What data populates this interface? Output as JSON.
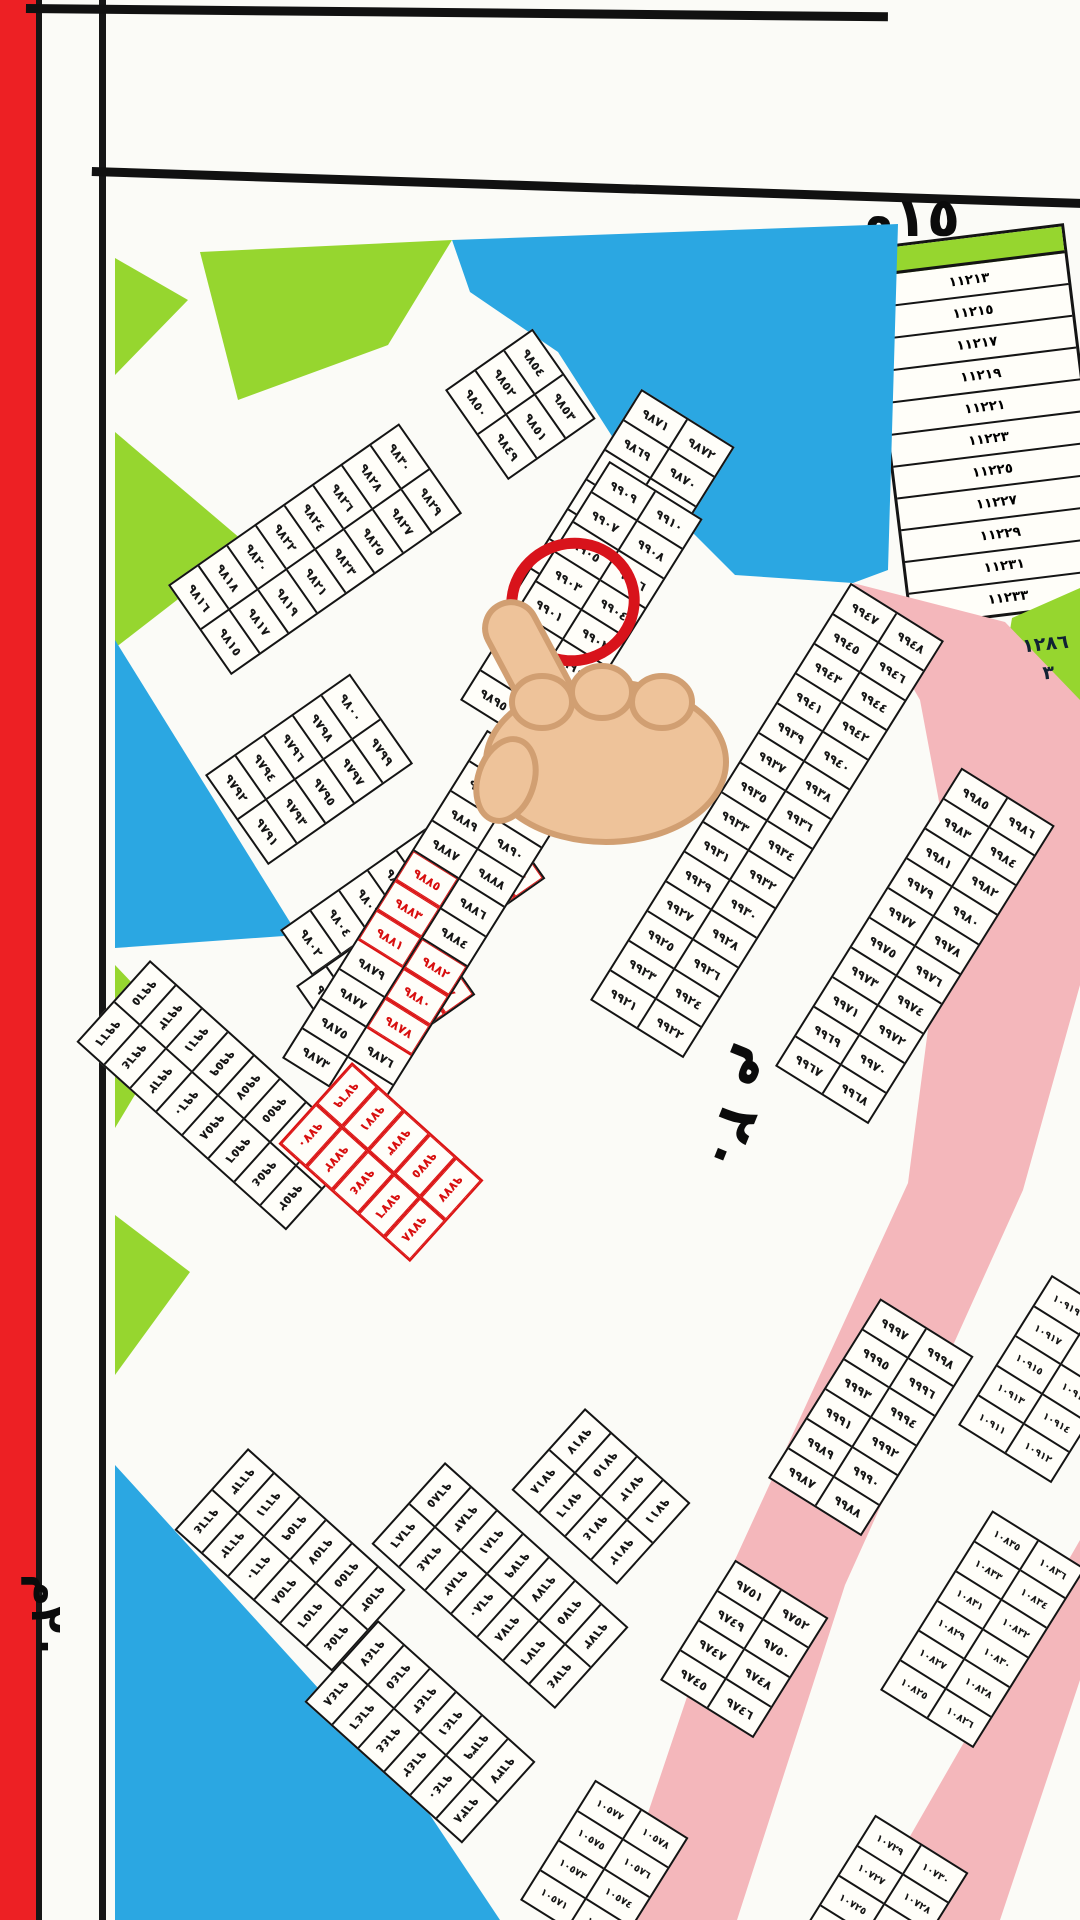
{
  "labels": {
    "street_top": "١٥م",
    "street_left": "٢٠م",
    "road_right": "٢٠ م",
    "green_block_line1": "١٢٨٦",
    "green_block_line2": "٣"
  },
  "highlight": {
    "circled_plot": "٩٩٠٣"
  },
  "colors": {
    "blue": "#2ba7e2",
    "green": "#96d62f",
    "pink": "#f4b7bb",
    "red_strip": "#ed2024",
    "circle_red": "#d8131b",
    "cell_red": "#db1212",
    "line_black": "#141414",
    "hand_skin": "#eec39a",
    "hand_outline": "#d19f72"
  },
  "right_column": {
    "cells": [
      "١١٢١٣",
      "١١٢١٥",
      "١١٢١٧",
      "١١٢١٩",
      "١١٢٢١",
      "١١٢٢٣",
      "١١٢٢٥",
      "١١٢٢٧",
      "١١٢٢٩",
      "١١٢٣١",
      "١١٢٣٣"
    ]
  },
  "zones": [
    {
      "name": "water-top",
      "color": "#2ba7e2",
      "points": "452px 240px, 898px 224px, 888px 570px, 853px 583px, 735px 575px, 640px 480px, 558px 352px, 470px 292px"
    },
    {
      "name": "green-top-trapezoid",
      "color": "#96d62f",
      "points": "200px 252px, 452px 240px, 388px 345px, 238px 400px"
    },
    {
      "name": "green-left-1",
      "color": "#96d62f",
      "points": "115px 258px, 188px 300px, 115px 375px"
    },
    {
      "name": "green-left-2",
      "color": "#96d62f",
      "points": "115px 432px, 248px 545px, 115px 648px"
    },
    {
      "name": "water-left",
      "color": "#2ba7e2",
      "points": "115px 640px, 298px 935px, 115px 948px"
    },
    {
      "name": "green-left-3",
      "color": "#96d62f",
      "points": "115px 965px, 175px 1028px, 115px 1128px"
    },
    {
      "name": "green-left-4",
      "color": "#96d62f",
      "points": "115px 1215px, 190px 1272px, 115px 1375px"
    },
    {
      "name": "water-bottom-left",
      "color": "#2ba7e2",
      "points": "115px 1465px, 420px 1800px, 500px 1920px, 115px 1920px"
    },
    {
      "name": "road-20m-main",
      "color": "#f4b7bb",
      "points": "853px 583px, 1005px 622px, 1080px 700px, 1080px 985px, 1023px 1190px, 845px 1585px, 737px 1920px, 612px 1920px, 728px 1575px, 908px 1183px, 950px 860px, 920px 700px"
    },
    {
      "name": "road-bottom-right",
      "color": "#f4b7bb",
      "points": "1080px 1540px, 1080px 1680px, 1000px 1920px, 862px 1920px"
    },
    {
      "name": "green-facility-block",
      "color": "#96d62f",
      "points": "1012px 618px, 1080px 588px, 1080px 758px, 1028px 748px, 1000px 690px"
    }
  ],
  "blocks": [
    {
      "name": "block-9815",
      "x": 168,
      "y": 585,
      "angle": -35,
      "top": [
        "٩٨١٦",
        "٩٨١٨",
        "٩٨٢٠",
        "٩٨٢٢",
        "٩٨٢٤",
        "٩٨٢٦",
        "٩٨٢٨",
        "٩٨٣٠"
      ],
      "bottom": [
        "٩٨١٥",
        "٩٨١٧",
        "٩٨١٩",
        "٩٨٢١",
        "٩٨٢٣",
        "٩٨٢٥",
        "٩٨٢٧",
        "٩٨٢٩"
      ],
      "redTop": [],
      "redBottom": []
    },
    {
      "name": "block-9849",
      "x": 445,
      "y": 390,
      "angle": -35,
      "top": [
        "٩٨٥٠",
        "٩٨٥٢",
        "٩٨٥٤"
      ],
      "bottom": [
        "٩٨٤٩",
        "٩٨٥١",
        "٩٨٥٣"
      ],
      "redTop": [],
      "redBottom": []
    },
    {
      "name": "block-9791",
      "x": 205,
      "y": 775,
      "angle": -35,
      "top": [
        "٩٧٩٢",
        "٩٧٩٤",
        "٩٧٩٦",
        "٩٧٩٨",
        "٩٨٠٠"
      ],
      "bottom": [
        "٩٧٩١",
        "٩٧٩٣",
        "٩٧٩٥",
        "٩٧٩٧",
        "٩٧٩٩"
      ],
      "redTop": [],
      "redBottom": []
    },
    {
      "name": "block-9801",
      "x": 280,
      "y": 930,
      "angle": -35,
      "top": [
        "٩٨٠٢",
        "٩٨٠٤",
        "٩٨٠٦",
        "٩٨٠٨",
        "٩٨١٠",
        "٩٨١٢",
        "٩٨١٤"
      ],
      "bottom": [
        "٩٨٠١",
        "٩٨٠٣",
        "٩٨٠٥",
        "٩٨٠٧",
        "٩٨٠٩",
        "٩٨١١",
        "٩٨١٣"
      ],
      "redTop": [],
      "redBottom": [
        "٩٨١١",
        "٩٨١٣"
      ]
    },
    {
      "name": "block-9781",
      "x": 296,
      "y": 986,
      "angle": -35,
      "top": [
        "٩٧٨٢",
        "٩٧٨٤",
        "٩٧٨٦",
        "٩٧٨٨"
      ],
      "bottom": [
        "٩٧٨١",
        "٩٧٨٣",
        "٩٧٨٥",
        "٩٧٨٧"
      ],
      "redTop": [
        "٩٧٨٦",
        "٩٧٨٨"
      ],
      "redBottom": [
        "٩٧٨٥",
        "٩٧٨٧"
      ]
    },
    {
      "name": "block-9857",
      "x": 492,
      "y": 628,
      "angle": -58,
      "top": [
        "٩٨٥٧",
        "٩٨٥٩",
        "٩٨٦١",
        "٩٨٦٣",
        "٩٨٦٥",
        "٩٨٦٧",
        "٩٨٦٩",
        "٩٨٧١"
      ],
      "bottom": [
        "٩٨٥٨",
        "٩٨٦٠",
        "٩٨٦٢",
        "٩٨٦٤",
        "٩٨٦٦",
        "٩٨٦٨",
        "٩٨٧٠",
        "٩٨٧٢"
      ],
      "redTop": [],
      "redBottom": []
    },
    {
      "name": "block-9895-circled",
      "x": 460,
      "y": 700,
      "angle": -58,
      "top": [
        "٩٨٩٥",
        "٩٨٩٧",
        "٩٨٩٩",
        "٩٩٠١",
        "٩٩٠٣",
        "٩٩٠٥",
        "٩٩٠٧",
        "٩٩٠٩"
      ],
      "bottom": [
        "٩٨٩٦",
        "٩٨٩٨",
        "٩٩٠٠",
        "٩٩٠٢",
        "٩٩٠٤",
        "٩٩٠٦",
        "٩٩٠٨",
        "٩٩١٠"
      ],
      "redTop": [],
      "redBottom": []
    },
    {
      "name": "block-9873",
      "x": 282,
      "y": 1058,
      "angle": -58,
      "top": [
        "٩٨٧٣",
        "٩٨٧٥",
        "٩٨٧٧",
        "٩٨٧٩",
        "٩٨٨١",
        "٩٨٨٣",
        "٩٨٨٥",
        "٩٨٨٧",
        "٩٨٨٩",
        "٩٨٩١",
        "٩٨٩٣"
      ],
      "bottom": [
        "٩٨٧٤",
        "٩٨٧٦",
        "٩٨٧٨",
        "٩٨٨٠",
        "٩٨٨٢",
        "٩٨٨٤",
        "٩٨٨٦",
        "٩٨٨٨",
        "٩٨٩٠",
        "٩٨٩٢",
        "٩٨٩٤"
      ],
      "redTop": [
        "٩٨٨١",
        "٩٨٨٣",
        "٩٨٨٥"
      ],
      "redBottom": [
        "٩٨٧٨",
        "٩٨٨٠",
        "٩٨٨٢"
      ]
    },
    {
      "name": "block-9921",
      "x": 590,
      "y": 1000,
      "angle": -58,
      "top": [
        "٩٩٢١",
        "٩٩٢٣",
        "٩٩٢٥",
        "٩٩٢٧",
        "٩٩٢٩",
        "٩٩٣١",
        "٩٩٣٣",
        "٩٩٣٥",
        "٩٩٣٧",
        "٩٩٣٩",
        "٩٩٤١",
        "٩٩٤٣",
        "٩٩٤٥",
        "٩٩٤٧"
      ],
      "bottom": [
        "٩٩٢٢",
        "٩٩٢٤",
        "٩٩٢٦",
        "٩٩٢٨",
        "٩٩٣٠",
        "٩٩٣٢",
        "٩٩٣٤",
        "٩٩٣٦",
        "٩٩٣٨",
        "٩٩٤٠",
        "٩٩٤٢",
        "٩٩٤٤",
        "٩٩٤٦",
        "٩٩٤٨"
      ],
      "redTop": [],
      "redBottom": []
    },
    {
      "name": "block-9967",
      "x": 775,
      "y": 1066,
      "angle": -58,
      "top": [
        "٩٩٦٧",
        "٩٩٦٩",
        "٩٩٧١",
        "٩٩٧٣",
        "٩٩٧٥",
        "٩٩٧٧",
        "٩٩٧٩",
        "٩٩٨١",
        "٩٩٨٣",
        "٩٩٨٥"
      ],
      "bottom": [
        "٩٩٦٨",
        "٩٩٧٠",
        "٩٩٧٢",
        "٩٩٧٤",
        "٩٩٧٦",
        "٩٩٧٨",
        "٩٩٨٠",
        "٩٩٨٢",
        "٩٩٨٤",
        "٩٩٨٦"
      ],
      "redTop": [],
      "redBottom": []
    },
    {
      "name": "block-9987",
      "x": 768,
      "y": 1478,
      "angle": -58,
      "top": [
        "٩٩٨٧",
        "٩٩٨٩",
        "٩٩٩١",
        "٩٩٩٣",
        "٩٩٩٥",
        "٩٩٩٧"
      ],
      "bottom": [
        "٩٩٨٨",
        "٩٩٩٠",
        "٩٩٩٢",
        "٩٩٩٤",
        "٩٩٩٦",
        "٩٩٩٨"
      ],
      "redTop": [],
      "redBottom": []
    },
    {
      "name": "block-9745",
      "x": 660,
      "y": 1680,
      "angle": -58,
      "top": [
        "٩٧٤٥",
        "٩٧٤٧",
        "٩٧٤٩",
        "٩٧٥١"
      ],
      "bottom": [
        "٩٧٤٦",
        "٩٧٤٨",
        "٩٧٥٠",
        "٩٧٥٢"
      ],
      "redTop": [],
      "redBottom": []
    },
    {
      "name": "block-9951",
      "x": 150,
      "y": 960,
      "angle": 42,
      "top": [
        "٩٩٦٥",
        "٩٩٦٣",
        "٩٩٦١",
        "٩٩٥٩",
        "٩٩٥٧",
        "٩٩٥٥",
        "٩٩٥٣",
        "٩٩٥١"
      ],
      "bottom": [
        "٩٩٦٦",
        "٩٩٦٤",
        "٩٩٦٢",
        "٩٩٦٠",
        "٩٩٥٨",
        "٩٩٥٦",
        "٩٩٥٤",
        "٩٩٥٢"
      ],
      "redTop": [],
      "redBottom": []
    },
    {
      "name": "block-9769-red",
      "x": 352,
      "y": 1062,
      "angle": 42,
      "allred": true,
      "top": [
        "٩٧٦٩",
        "٩٧٧١",
        "٩٧٧٣",
        "٩٧٧٥",
        "٩٧٧٧"
      ],
      "bottom": [
        "٩٧٧٠",
        "٩٧٧٢",
        "٩٧٧٤",
        "٩٧٧٦",
        "٩٧٧٨"
      ],
      "redTop": [
        "٩٧٦٩",
        "٩٧٧١",
        "٩٧٧٣",
        "٩٧٧٥",
        "٩٧٧٧"
      ],
      "redBottom": [
        "٩٧٧٠",
        "٩٧٧٢",
        "٩٧٧٤",
        "٩٧٧٦",
        "٩٧٧٨"
      ]
    },
    {
      "name": "block-9653",
      "x": 248,
      "y": 1448,
      "angle": 42,
      "top": [
        "٩٦٦٣",
        "٩٦٦١",
        "٩٦٥٩",
        "٩٦٥٧",
        "٩٦٥٥",
        "٩٦٥٣"
      ],
      "bottom": [
        "٩٦٦٤",
        "٩٦٦٢",
        "٩٦٦٠",
        "٩٦٥٨",
        "٩٦٥٦",
        "٩٦٥٤"
      ],
      "redTop": [],
      "redBottom": []
    },
    {
      "name": "block-9637",
      "x": 378,
      "y": 1620,
      "angle": 42,
      "top": [
        "٩٦٤٧",
        "٩٦٤٥",
        "٩٦٤٣",
        "٩٦٤١",
        "٩٦٣٩",
        "٩٦٣٧"
      ],
      "bottom": [
        "٩٦٤٨",
        "٩٦٤٦",
        "٩٦٤٤",
        "٩٦٤٢",
        "٩٦٤٠",
        "٩٦٣٨"
      ],
      "redTop": [],
      "redBottom": []
    },
    {
      "name": "block-9673",
      "x": 445,
      "y": 1462,
      "angle": 42,
      "top": [
        "٩٦٨٥",
        "٩٦٨٣",
        "٩٦٨١",
        "٩٦٧٩",
        "٩٦٧٧",
        "٩٦٧٥",
        "٩٦٧٣"
      ],
      "bottom": [
        "٩٦٨٦",
        "٩٦٨٤",
        "٩٦٨٢",
        "٩٦٨٠",
        "٩٦٧٨",
        "٩٦٧٦",
        "٩٦٧٤"
      ],
      "redTop": [],
      "redBottom": []
    },
    {
      "name": "block-9711",
      "x": 585,
      "y": 1408,
      "angle": 42,
      "top": [
        "٩٧١٧",
        "٩٧١٥",
        "٩٧١٣",
        "٩٧١١"
      ],
      "bottom": [
        "٩٧١٨",
        "٩٧١٦",
        "٩٧١٤",
        "٩٧١٢"
      ],
      "redTop": [],
      "redBottom": []
    },
    {
      "name": "block-10911",
      "x": 958,
      "y": 1425,
      "angle": -58,
      "top": [
        "١٠٩١١",
        "١٠٩١٣",
        "١٠٩١٥",
        "١٠٩١٧",
        "١٠٩١٩"
      ],
      "bottom": [
        "١٠٩١٢",
        "١٠٩١٤",
        "١٠٩١٦",
        "١٠٩١٨",
        "١٠٩٢٠"
      ],
      "redTop": [],
      "redBottom": []
    },
    {
      "name": "block-10825",
      "x": 880,
      "y": 1690,
      "angle": -58,
      "top": [
        "١٠٨٢٥",
        "١٠٨٢٧",
        "١٠٨٢٩",
        "١٠٨٣١",
        "١٠٨٣٣",
        "١٠٨٣٥"
      ],
      "bottom": [
        "١٠٨٢٦",
        "١٠٨٢٨",
        "١٠٨٣٠",
        "١٠٨٣٢",
        "١٠٨٣٤",
        "١٠٨٣٦"
      ],
      "redTop": [],
      "redBottom": []
    },
    {
      "name": "block-10723",
      "x": 800,
      "y": 1935,
      "angle": -58,
      "top": [
        "١٠٧٢٣",
        "١٠٧٢٥",
        "١٠٧٢٧",
        "١٠٧٢٩"
      ],
      "bottom": [
        "١٠٧٢٤",
        "١٠٧٢٦",
        "١٠٧٢٨",
        "١٠٧٣٠"
      ],
      "redTop": [],
      "redBottom": []
    },
    {
      "name": "block-10571",
      "x": 520,
      "y": 1900,
      "angle": -58,
      "top": [
        "١٠٥٧١",
        "١٠٥٧٣",
        "١٠٥٧٥",
        "١٠٥٧٧"
      ],
      "bottom": [
        "١٠٥٧٢",
        "١٠٥٧٤",
        "١٠٥٧٦",
        "١٠٥٧٨"
      ],
      "redTop": [],
      "redBottom": []
    }
  ]
}
